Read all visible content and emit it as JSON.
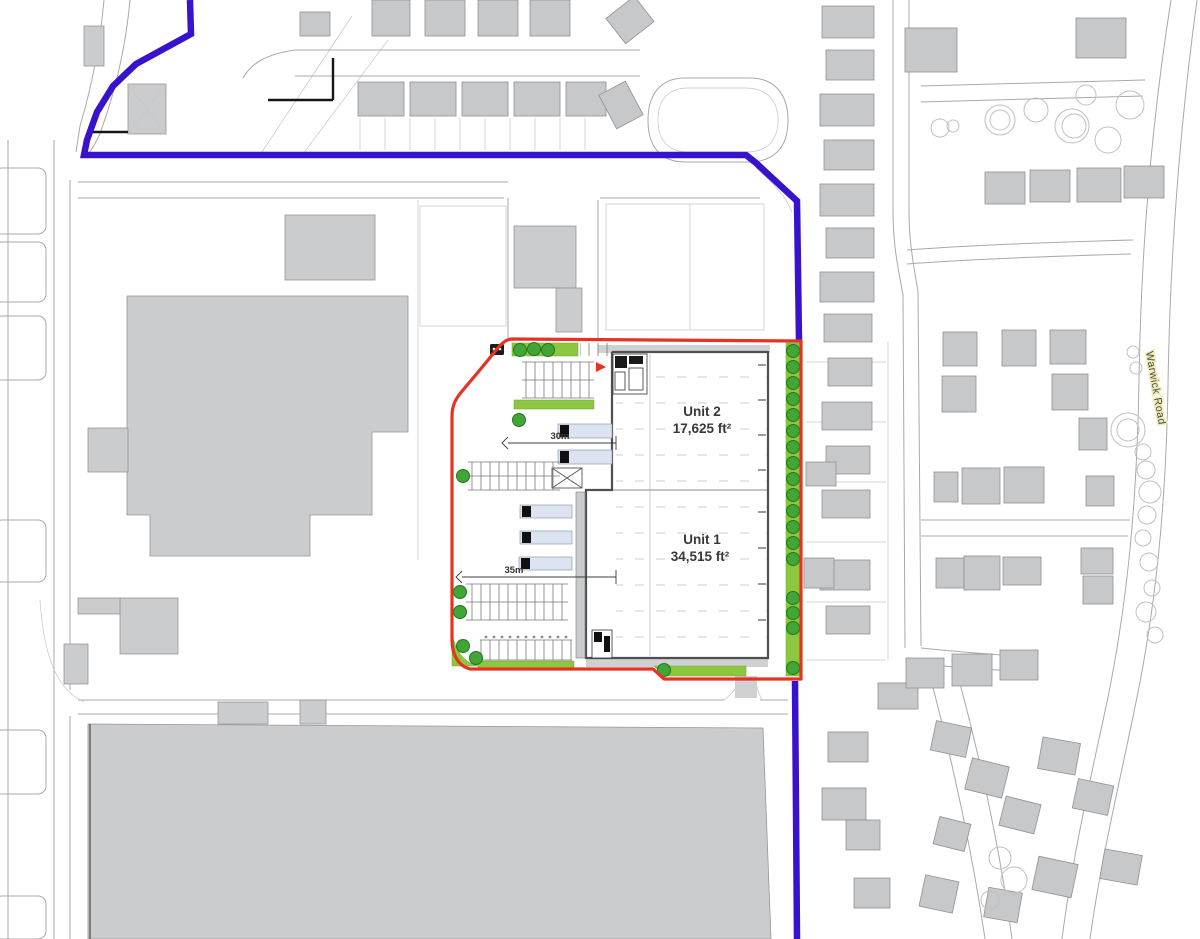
{
  "plan": {
    "unit2": {
      "name": "Unit 2",
      "area": "17,625 ft²"
    },
    "unit1": {
      "name": "Unit 1",
      "area": "34,515 ft²"
    },
    "dimensions": {
      "unit2_yard": "30m",
      "unit1_yard": "35m"
    },
    "road_name": "Warwick Road"
  },
  "colors": {
    "blue": "#3812cd",
    "red": "#e73223",
    "green": "#8dc63f",
    "tree": "#43a536",
    "treedark": "#1d7a1f",
    "building": "#caccce",
    "canopy": "#dbe4f0"
  }
}
